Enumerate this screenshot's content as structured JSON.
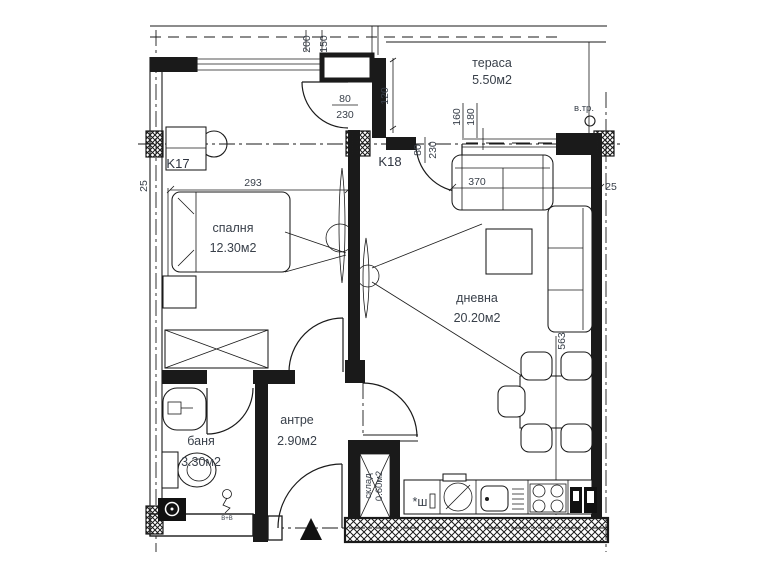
{
  "plan": {
    "rooms": [
      {
        "name": "спалня",
        "area": "12.30м2"
      },
      {
        "name": "дневна",
        "area": "20.20м2"
      },
      {
        "name": "тераса",
        "area": "5.50м2"
      },
      {
        "name": "баня",
        "area": "3.30м2"
      },
      {
        "name": "антре",
        "area": "2.90м2"
      },
      {
        "name": "склад",
        "area": "0.60м2"
      }
    ],
    "columns": {
      "k17": "K17",
      "k18": "K18"
    },
    "dims": {
      "top_a": "200",
      "top_b": "150",
      "niche": "120",
      "win_a": "160",
      "win_b": "180",
      "bed": "293",
      "living_w": "370",
      "living_h": "563",
      "wall_left": "25",
      "wall_right": "25",
      "door_bedroom_w": "80",
      "door_bedroom_h": "230",
      "door_terrace_w": "80",
      "door_terrace_h": "230"
    },
    "annotations": {
      "vent": "в.тр.",
      "riser": "В+В",
      "kitchen_mark": "*ш"
    }
  },
  "colors": {
    "line": "#1a1a1a",
    "text": "#39404a",
    "background": "#ffffff"
  }
}
